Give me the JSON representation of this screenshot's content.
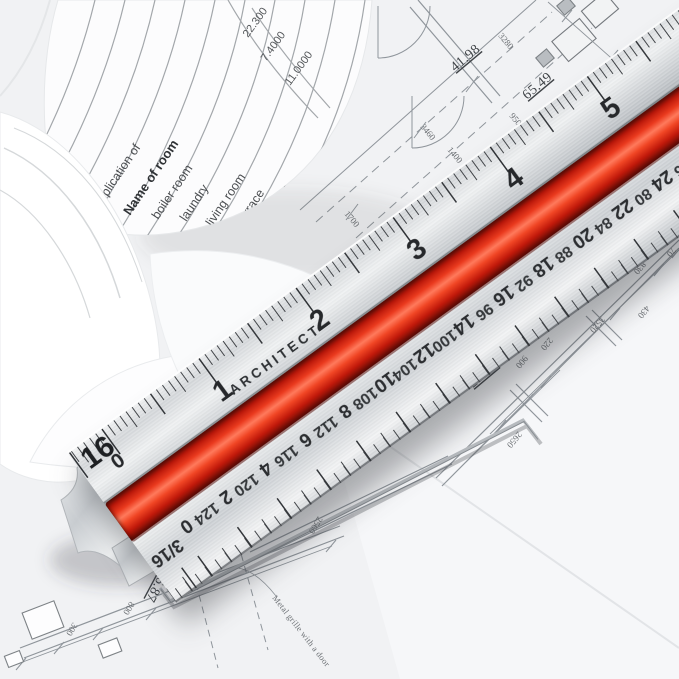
{
  "colors": {
    "accent_red": "#d82c12",
    "aluminum": "#cfd3d6",
    "blueprint_line": "#8f959b"
  },
  "ruler": {
    "brand": "ARCHITECT",
    "scale_16": {
      "label": "16",
      "zero": "0",
      "numbers": [
        "1",
        "2",
        "3",
        "4",
        "5"
      ]
    },
    "scale_316": {
      "label": "3/16",
      "series_a": [
        "0",
        "2",
        "4",
        "6",
        "8",
        "10",
        "12",
        "14",
        "16",
        "18",
        "20",
        "22",
        "24",
        "26"
      ],
      "series_b": [
        "124",
        "120",
        "116",
        "112",
        "108",
        "104",
        "100",
        "96",
        "92",
        "88",
        "84",
        "80",
        "76",
        "72"
      ]
    }
  },
  "paper_table": {
    "side_label": "explication of",
    "header": "Name of room",
    "rooms": [
      "boiler room",
      "laundry",
      "living room",
      "terrace",
      "kitchen",
      "hall",
      "room"
    ],
    "values": [
      "22.300",
      "7.4000",
      "11.0000"
    ]
  },
  "blueprint": {
    "labels": [
      "41.98",
      "65.49",
      "21.20",
      "21.60",
      "6.87",
      "45.22",
      "3280",
      "950",
      "1400",
      "970",
      "3460",
      "1700",
      "3520",
      "830",
      "70",
      "900",
      "220",
      "2650",
      "1050",
      "2560",
      "800",
      "300",
      "430"
    ],
    "note": "Metal grille with a door"
  }
}
